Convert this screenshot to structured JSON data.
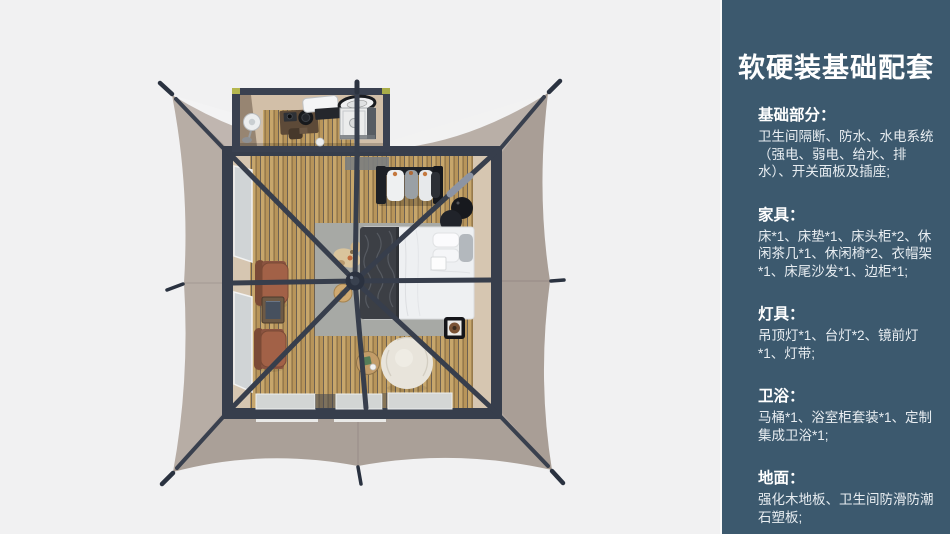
{
  "page": {
    "background": "#f1f1f2"
  },
  "sidebar": {
    "bg_color": "#3c596e",
    "text_color": "#ffffff",
    "title": "软硬装基础配套",
    "sections": [
      {
        "heading": "基础部分：",
        "body": "卫生间隔断、防水、水电系统（强电、弱电、给水、排水）、开关面板及插座;"
      },
      {
        "heading": "家具：",
        "body": "床*1、床垫*1、床头柜*2、休闲茶几*1、休闲椅*2、衣帽架*1、床尾沙发*1、边柜*1;"
      },
      {
        "heading": "灯具：",
        "body": "吊顶灯*1、台灯*2、镜前灯*1、灯带;"
      },
      {
        "heading": "卫浴：",
        "body": "马桶*1、浴室柜套装*1、定制集成卫浴*1;"
      },
      {
        "heading": "地面：",
        "body": "强化木地板、卫生间防滑防潮石塑板;"
      }
    ]
  },
  "scene": {
    "description": "top-down 3D render of a glamping safari tent with integrated bathroom pod",
    "colors": {
      "tent_canvas": "#b4a9a1",
      "frame_poles": "#373e4c",
      "wood_floor": "#c2a064",
      "rug": "#a7a9a5",
      "bed": "#eff0f2",
      "leather_chair": "#a26147",
      "pouf": "#e8e4db",
      "corner_accent": "#b5b74f"
    },
    "objects": [
      "tent-canvas",
      "guy-line-stakes",
      "bathroom-pod",
      "pedestal-fan",
      "bathroom-vanity",
      "toilet",
      "shower-tray",
      "skylight-panel",
      "clothes-rack",
      "bedside-tables",
      "bed",
      "bed-throw",
      "area-rug",
      "tray-table",
      "pouf-ottoman",
      "coffee-table",
      "leisure-chairs",
      "side-table",
      "glass-doors",
      "window-panels",
      "frame-poles",
      "center-hub",
      "wood-stool",
      "pet-on-rug"
    ]
  }
}
